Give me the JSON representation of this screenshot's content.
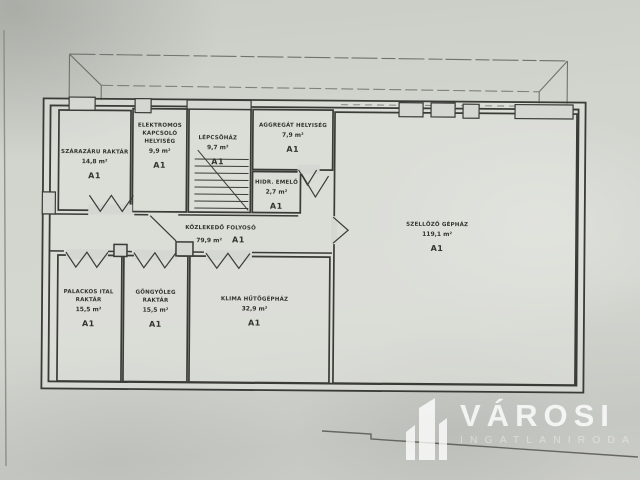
{
  "floor_plan": {
    "unit_label": "A1",
    "ink_color": "#3a3a36",
    "paper_color": "#d2d4ce",
    "rooms": [
      {
        "id": "szarazaru-raktar",
        "name": "SZÁRAZÁRU RAKTÁR",
        "area": "14,8 m²",
        "unit": "A1"
      },
      {
        "id": "elektromos-kapcsolo-helyiseg",
        "name": "ELEKTROMOS KAPCSOLÓ HELYISÉG",
        "area": "9,9 m²",
        "unit": "A1"
      },
      {
        "id": "lepcsohaz",
        "name": "LÉPCSŐHÁZ",
        "area": "9,7 m²",
        "unit": "A1"
      },
      {
        "id": "aggregat-helyiseg",
        "name": "AGGREGÁT HELYISÉG",
        "area": "7,9 m²",
        "unit": "A1"
      },
      {
        "id": "hidr-emelo",
        "name": "HIDR. EMELŐ",
        "area": "2,7 m²",
        "unit": "A1"
      },
      {
        "id": "kozlekedo-folyoso",
        "name": "KÖZLEKEDŐ FOLYOSÓ",
        "area": "79,9 m²",
        "unit": "A1"
      },
      {
        "id": "szellozo-gephaz",
        "name": "SZELLŐZŐ GÉPHÁZ",
        "area": "119,1 m²",
        "unit": "A1"
      },
      {
        "id": "palackos-ital-raktar",
        "name": "PALACKOS ITAL RAKTÁR",
        "area": "15,5 m²",
        "unit": "A1"
      },
      {
        "id": "gongyoleg-raktar",
        "name": "GÖNGYÖLEG RAKTÁR",
        "area": "15,5 m²",
        "unit": "A1"
      },
      {
        "id": "klima-hutogephaz",
        "name": "KLIMA HŰTŐGÉPHÁZ",
        "area": "32,9 m²",
        "unit": "A1"
      }
    ]
  },
  "watermark": {
    "brand": "VÁROSI",
    "subtitle": "INGATLANIRODA",
    "logo": "city-buildings-icon",
    "text_color": "#ffffff"
  }
}
